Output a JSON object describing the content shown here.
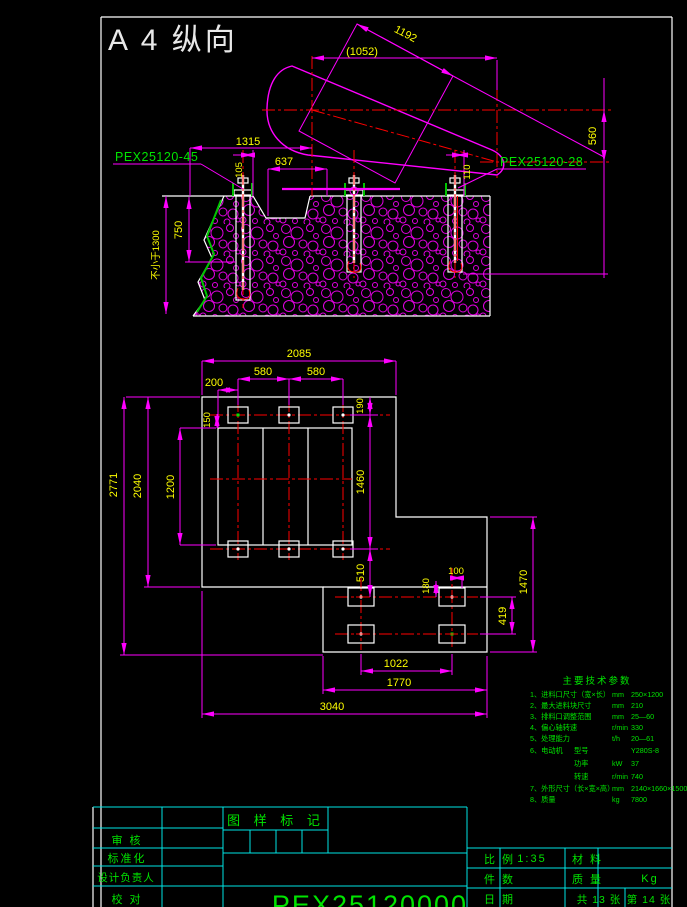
{
  "sheet": {
    "format_label": "A 4 纵向"
  },
  "elevation": {
    "part_label_left": "PEX25120-45",
    "part_label_right": "PEX25120-28",
    "dims": {
      "rect_edge": "1192",
      "top_width": "(1052)",
      "center_offset": "560",
      "left_width": "1315",
      "pocket_width": "637",
      "bolt_left": "105",
      "bolt_right": "110",
      "bolt_embed": "750",
      "foundation_depth": "不小于1300"
    }
  },
  "plan": {
    "dims": {
      "top_width": "2085",
      "bolt_margin": "200",
      "bolt_pitch_a": "580",
      "bolt_pitch_b": "580",
      "opening_offset": "150",
      "top_edge_offset": "190",
      "opening_height": "1200",
      "bolt_row_spacing": "1460",
      "left_height": "2040",
      "total_height": "2771",
      "step_offset": "510",
      "motor_bolt_a": "180",
      "motor_bolt_b": "100",
      "motor_row_spacing": "419",
      "right_height": "1470",
      "motor_bolt_pitch": "1022",
      "lower_width": "1770",
      "total_width": "3040"
    }
  },
  "tech_params": {
    "title": "主要技术参数",
    "rows": [
      {
        "name": "1、进料口尺寸（宽×长）",
        "sub": "",
        "unit": "mm",
        "value": "250×1200"
      },
      {
        "name": "2、最大进料块尺寸",
        "sub": "",
        "unit": "mm",
        "value": "210"
      },
      {
        "name": "3、排料口调整范围",
        "sub": "",
        "unit": "mm",
        "value": "25—60"
      },
      {
        "name": "4、偏心轴转速",
        "sub": "",
        "unit": "r/min",
        "value": "330"
      },
      {
        "name": "5、处理能力",
        "sub": "",
        "unit": "t/h",
        "value": "20—61"
      },
      {
        "name": "6、电动机",
        "sub": "型号",
        "unit": "",
        "value": "Y280S-8"
      },
      {
        "name": "",
        "sub": "功率",
        "unit": "kW",
        "value": "37"
      },
      {
        "name": "",
        "sub": "转速",
        "unit": "r/min",
        "value": "740"
      },
      {
        "name": "7、外形尺寸（长×宽×高）",
        "sub": "",
        "unit": "mm",
        "value": "2140×1660×1500"
      },
      {
        "name": "8、质量",
        "sub": "",
        "unit": "kg",
        "value": "7800"
      }
    ]
  },
  "title_block": {
    "stamp_header": "图 样 标 记",
    "row_reviewer": "审  核",
    "row_standard": "标准化",
    "row_design_lead": "设计负责人",
    "row_proofread": "校  对",
    "scale_label": "比 例",
    "scale_value": "1:35",
    "material_label": "材 料",
    "qty_label": "件 数",
    "mass_label": "质 量",
    "mass_unit": "Kg",
    "date_label": "日 期",
    "sheets_total": "共 13 张",
    "sheet_number": "第 14 张",
    "drawing_number": "PEX25120000"
  }
}
